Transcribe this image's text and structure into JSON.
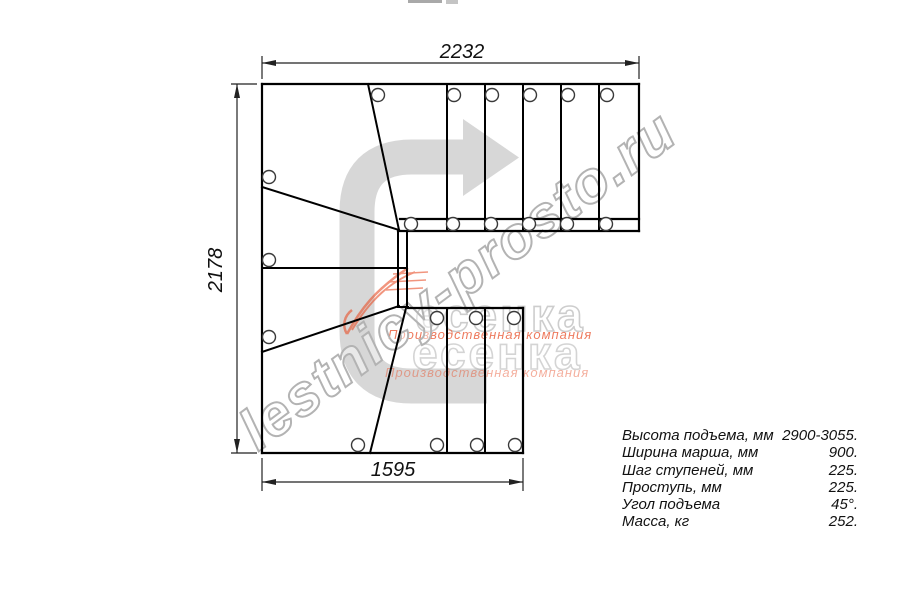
{
  "drawing": {
    "title": "stair-plan-top-view",
    "top_dimension": "2232",
    "left_dimension": "2178",
    "bottom_dimension": "1595"
  },
  "watermark": {
    "site_text": "lestnicy-prosto.ru",
    "logo_text_row1": "есенка",
    "logo_text_row2": "есенка",
    "logo_caption_row1": "Производственная компания",
    "logo_caption_row2": "Производственная компания"
  },
  "specs": {
    "rows": [
      {
        "label": "Высота подъема, мм",
        "value": "2900-3055."
      },
      {
        "label": "Ширина марша, мм",
        "value": "900."
      },
      {
        "label": "Шаг ступеней, мм",
        "value": "225."
      },
      {
        "label": "Проступь, мм",
        "value": "225."
      },
      {
        "label": "Угол подъема",
        "value": "45°."
      },
      {
        "label": "Масса, кг",
        "value": "252."
      }
    ]
  },
  "colors": {
    "line": "#000000",
    "dimension": "#222222",
    "direction_arrow": "#d7d7d7",
    "logo_red": "#e8502a",
    "logo_gray": "#b0b0b0"
  }
}
